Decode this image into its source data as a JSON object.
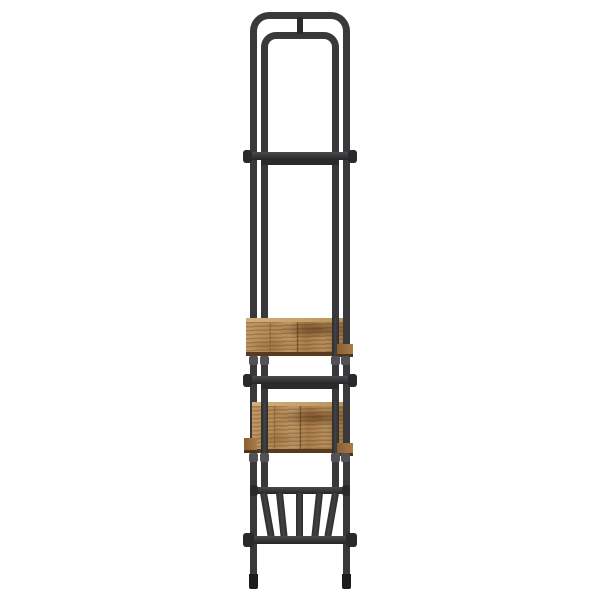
{
  "scene": {
    "description": "Side-view product photo of a tall narrow industrial-style rack: dark grey steel frame made of two nested round-cornered arches joined by a short stub at the top, two horizontal rails, two rustic brown engineered-wood shelves in the lower half, a splayed-slat steel bottom shelf, and legs with dark foot caps, on a plain white background",
    "background": "#ffffff"
  },
  "colors": {
    "background": "#ffffff",
    "metal": "#39393b",
    "metal_dark": "#2a2a2c",
    "metal_light": "#48484a",
    "metal_cap": "#515156",
    "foot": "#1c1c1e",
    "wood_base": "#b08a58",
    "wood_light": "#cfa974",
    "wood_dark": "#8a5f33",
    "wood_edge_bottom": "#573a1f"
  },
  "structure": {
    "frame_style": "double rounded arch, tubular steel",
    "shelf_count": 2,
    "rail_count": 2,
    "slat_count": 5,
    "leg_count": 2,
    "view": "side"
  }
}
